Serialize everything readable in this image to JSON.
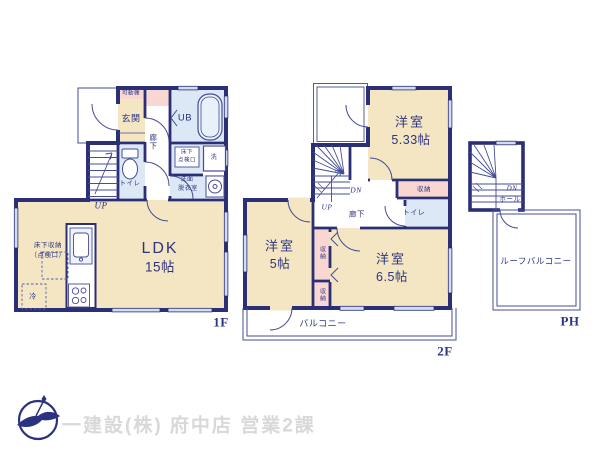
{
  "plan": {
    "floor1": {
      "floor_label": "1F",
      "rooms": {
        "entrance": "玄関",
        "movable_shelf": "可動棚",
        "hallway": "廊下",
        "unit_bath": "UB",
        "underfloor_hatch_line1": "床下",
        "underfloor_hatch_line2": "点検口",
        "laundry": "洗",
        "washroom_line1": "洗面",
        "washroom_line2": "脱衣室",
        "toilet": "トイレ",
        "stairs_up": "UP",
        "ldk_name": "LDK",
        "ldk_size": "15帖",
        "underfloor_storage_line1": "床下収納",
        "underfloor_storage_line2": "（点検口）",
        "refrigerator": "冷"
      }
    },
    "floor2": {
      "floor_label": "2F",
      "rooms": {
        "bedroom_a_name": "洋室",
        "bedroom_a_size": "5.33帖",
        "closet_a": "収納",
        "stairs_down": "DN",
        "stairs_up": "UP",
        "hallway": "廊下",
        "toilet": "トイレ",
        "bedroom_b_name": "洋室",
        "bedroom_b_size": "5帖",
        "closet_b": "収納",
        "closet_c": "収納",
        "bedroom_c_name": "洋室",
        "bedroom_c_size": "6.5帖",
        "balcony": "バルコニー"
      }
    },
    "penthouse": {
      "floor_label": "PH",
      "rooms": {
        "stairs_down": "DN",
        "hall": "ホール",
        "roof_balcony": "ルーフバルコニー"
      }
    }
  },
  "footer": {
    "company_caption": "一建設(株) 府中店 営業2課"
  },
  "colors": {
    "wall_navy": "#2b2f76",
    "room_cream": "#f4e6c2",
    "wet_area_blue": "#dce8f5",
    "closet_pink": "#f8d6d2",
    "window_blue": "#cfdef1",
    "caption_gray": "#d8d8da",
    "logo_navy": "#2b3280"
  }
}
